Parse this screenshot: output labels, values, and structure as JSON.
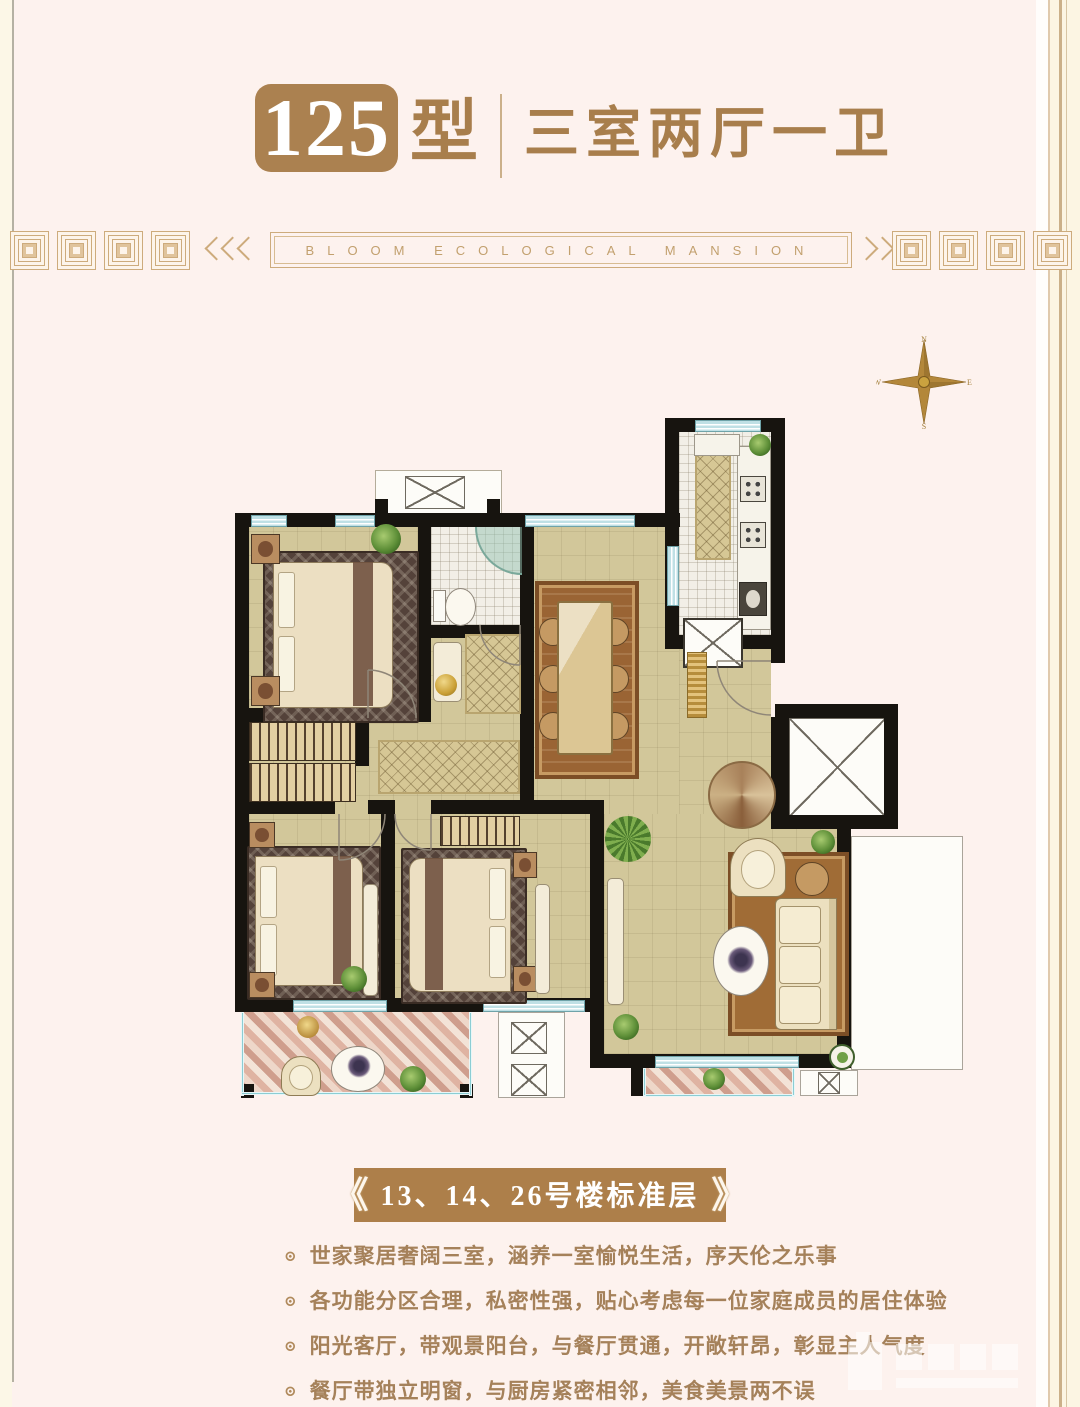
{
  "header": {
    "badge": "125",
    "type_suffix": "型",
    "subtitle": "三室两厅一卫"
  },
  "ribbon": {
    "text": "BLOOM ECOLOGICAL MANSION"
  },
  "compass": {
    "north": "N",
    "east": "E",
    "south": "S",
    "west": "W"
  },
  "banner": {
    "open": "《",
    "text": "13、14、26号楼标准层",
    "close": "》"
  },
  "features": {
    "marker": "⊙",
    "items": [
      "世家聚居奢阔三室，涵养一室愉悦生活，序天伦之乐事",
      "各功能分区合理，私密性强，贴心考虑每一位家庭成员的居住体验",
      "阳光客厅，带观景阳台，与餐厅贯通，开敞轩昂，彰显主人气度",
      "餐厅带独立明窗，与厨房紧密相邻，美食美景两不误"
    ]
  },
  "colors": {
    "accent_gold": "#ab8150",
    "text_brown": "#a5815a",
    "ribbon_gold": "#cdab7c",
    "wall": "#17140f",
    "floor": "#d2c79a",
    "window_blue": "#bfe0e5",
    "balcony_pink": "#dfb3a2",
    "page_bg": "#fdf2ee"
  }
}
